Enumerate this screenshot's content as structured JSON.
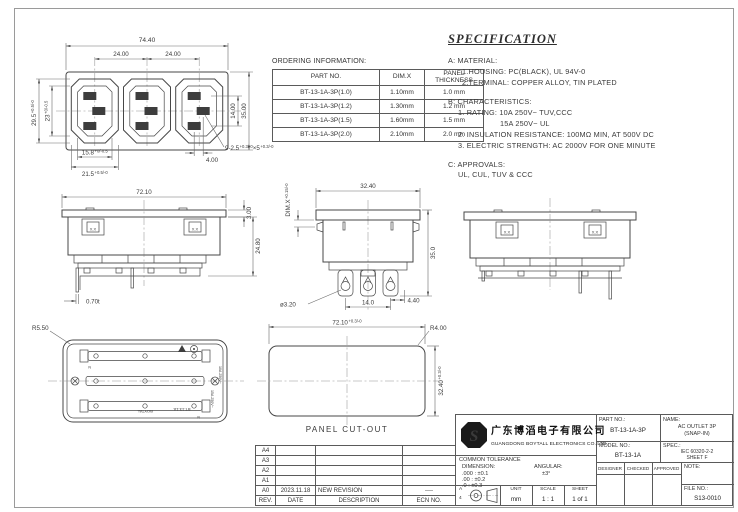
{
  "front_view": {
    "dim_total_width": "74.40",
    "dim_pitch_left": "24.00",
    "dim_pitch_right": "24.00",
    "dim_face_h": "29.5",
    "dim_face_h_tol": "+0.5/-0",
    "dim_inner_h": "23",
    "dim_inner_h_tol": "+0/-0.5",
    "dim_inner_w": "15.8",
    "dim_inner_w_tol": "+0/-0.5",
    "dim_face_w": "21.5",
    "dim_face_w_tol": "+0.5/-0",
    "dim_slot_v": "14.00",
    "dim_total_h": "35.00",
    "dim_slot_offset": "4.00",
    "slot_note": "9-2.5",
    "slot_note_tol1": "+0.3/-0",
    "slot_note_mid": "×5",
    "slot_note_tol2": "+0.3/-0"
  },
  "ordering": {
    "title": "ORDERING INFORMATION:",
    "col_part": "PART NO.",
    "col_dimx": "DIM.X",
    "col_panel_1": "PANEL",
    "col_panel_2": "THICKNESS",
    "rows": [
      {
        "part": "BT-13-1A-3P(1.0)",
        "dimx": "1.10mm",
        "panel": "1.0 mm"
      },
      {
        "part": "BT-13-1A-3P(1.2)",
        "dimx": "1.30mm",
        "panel": "1.2 mm"
      },
      {
        "part": "BT-13-1A-3P(1.5)",
        "dimx": "1.60mm",
        "panel": "1.5 mm"
      },
      {
        "part": "BT-13-1A-3P(2.0)",
        "dimx": "2.10mm",
        "panel": "2.0 mm"
      }
    ]
  },
  "spec": {
    "title": "SPECIFICATION",
    "a_head": "A:  MATERIAL:",
    "a1": "1.HOUSING:  PC(BLACK), UL 94V-0",
    "a2": "2.TERMINAL:  COPPER ALLOY, TIN PLATED",
    "b_head": "B:  CHARACTERISTICS:",
    "b1": "1.  RATING:  10A  250V~  TUV,CCC",
    "b1b": "15A  250V~  UL",
    "b2": "2.  INSULATION  RESISTANCE:  100MΩ MIN, AT 500V DC",
    "b3": "3.  ELECTRIC  STRENGTH:  AC 2000V FOR ONE MINUTE",
    "c_head": "C:  APPROVALS:",
    "c1": "UL, CUL, TUV & CCC"
  },
  "side_view": {
    "dim_width": "72.10",
    "dim_flange": "3.00",
    "dim_height": "24.80",
    "dim_pin": "0.70t",
    "clip_mark": "X.X"
  },
  "end_view": {
    "dim_width": "32.40",
    "dim_x": "DIM.X",
    "dim_x_tol": "+0.15/-0",
    "dim_height": "35.0",
    "dim_pin_d": "ø3.20",
    "dim_pitch": "14.0",
    "dim_offset": "4.40"
  },
  "rear_view": {
    "clip_mark": "X.X"
  },
  "bottom_view": {
    "dim_radius": "R5.50",
    "brand": "BOYTAL",
    "model": "BT-13-1A",
    "rating1": "10A 250V~",
    "rating2": "15A 250V~",
    "n_mark": "N"
  },
  "panel_cutout": {
    "dim_width": "72.10",
    "dim_width_tol": "+0.3/-0",
    "dim_corner": "R4.00",
    "dim_height": "32.40",
    "dim_height_tol": "+0.3/-0",
    "label": "PANEL CUT-OUT"
  },
  "revisions": {
    "headers": {
      "rev": "REV.",
      "date": "DATE",
      "desc": "DESCRIPTION",
      "ecn": "ECN NO."
    },
    "rows": [
      {
        "rev": "A4",
        "date": "",
        "desc": "",
        "ecn": ""
      },
      {
        "rev": "A3",
        "date": "",
        "desc": "",
        "ecn": ""
      },
      {
        "rev": "A2",
        "date": "",
        "desc": "",
        "ecn": ""
      },
      {
        "rev": "A1",
        "date": "",
        "desc": "",
        "ecn": ""
      },
      {
        "rev": "A0",
        "date": "2023.11.18",
        "desc": "NEW REVISION",
        "ecn": "----"
      }
    ]
  },
  "title_block": {
    "company_cn": "广东博滔电子有限公司",
    "company_en": "GUANGDONG BOYTALL ELECTRONICS CO.,LTD",
    "part_no_label": "PART NO.:",
    "part_no": "BT-13-1A-3P",
    "name_label": "NAME:",
    "name_line1": "AC OUTLET 3P",
    "name_line2": "(SNAP-IN)",
    "model_no_label": "MODEL NO.:",
    "model_no": "BT-13-1A",
    "spec_label": "SPEC.:",
    "spec_line1": "IEC 60320-2-2",
    "spec_line2": "SHEET F",
    "designer": "DESIGNER",
    "checked": "CHECKED",
    "approved": "APPROVED",
    "note_label": "NOTE:",
    "file_no_label": "FILE NO.:",
    "file_no": "S13-0010",
    "tolerance_title": "COMMON TOLERANCE",
    "dimension_label": "DIMENSION:",
    "angular_label": "ANGULAR:",
    "tol1": ".000 : ±0.1",
    "tol2": ".00  : ±0.2",
    "tol3": ".0   : ±0.3",
    "angular_value": "±3°",
    "unit_label": "UNIT",
    "unit_value": "mm",
    "scale_label": "SCALE",
    "scale_value": "1 : 1",
    "sheet_label": "SHEET",
    "sheet_value": "1 of 1",
    "size_letter": "A",
    "size_num": "4"
  }
}
